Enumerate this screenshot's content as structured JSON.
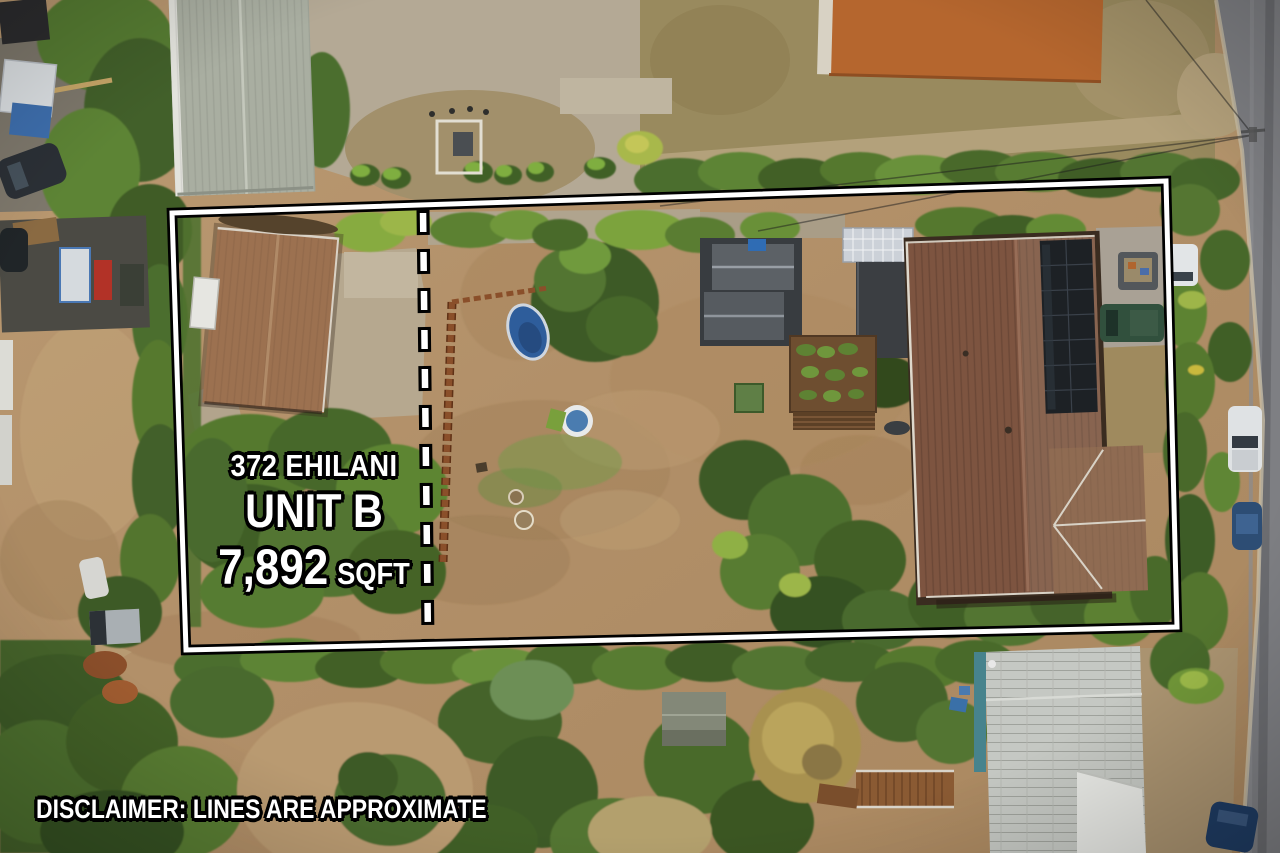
{
  "annotation": {
    "address": "372 EHILANI",
    "unit": "UNIT B",
    "area_value": "7,892",
    "area_unit": "SQFT",
    "disclaimer": "DISCLAIMER: LINES ARE APPROXIMATE",
    "line_color": "#ffffff",
    "line_outline_color": "#000000",
    "text_color": "#ffffff",
    "text_outline_color": "#000000"
  },
  "scene": {
    "type": "aerial-drone-photo-of-residential-lot",
    "features": [
      "property-boundary-outline",
      "unit-divider-dashed-line",
      "cottage-brown-roof",
      "main-house-brown-roof-with-solar-panels",
      "storage-sheds",
      "pergola",
      "carport",
      "inflatable-pool",
      "kiddie-pool",
      "wood-fence",
      "garden-beds",
      "street-right-edge",
      "parked-vehicles",
      "dense-vegetation"
    ]
  }
}
